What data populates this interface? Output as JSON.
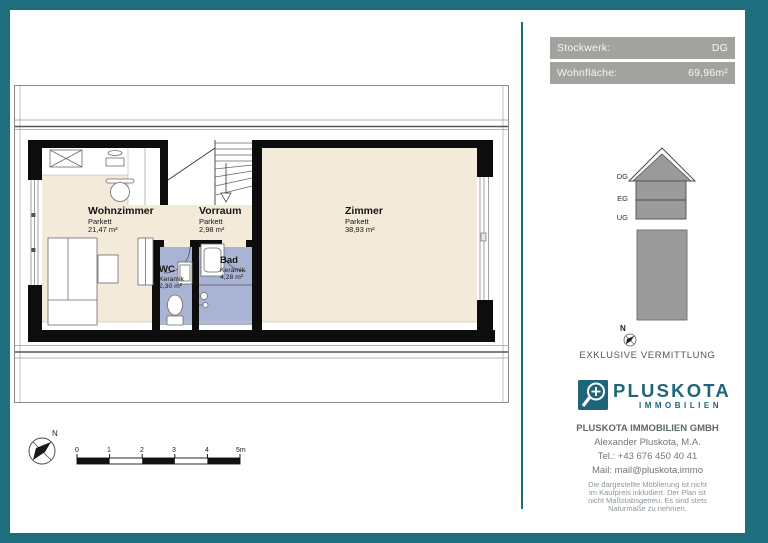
{
  "colors": {
    "frame_teal": "#1E6F7E",
    "logo_teal": "#1F6579",
    "header_gray": "#A2A29E",
    "floor_parquet": "#F3EAD9",
    "floor_ceramic": "#A9B3D4",
    "wall_black": "#0D0D0D",
    "diagram_gray": "#9B9B9B"
  },
  "header": {
    "rows": [
      {
        "label": "Stockwerk:",
        "value": "DG"
      },
      {
        "label": "Wohnfläche:",
        "value": "69,96m²"
      }
    ]
  },
  "plan": {
    "compass_label": "N",
    "rooms": [
      {
        "name": "Wohnzimmer",
        "floor": "Parkett",
        "area": "21,47 m²"
      },
      {
        "name": "Vorraum",
        "floor": "Parkett",
        "area": "2,98 m²"
      },
      {
        "name": "Zimmer",
        "floor": "Parkett",
        "area": "38,93 m²"
      },
      {
        "name": "WC",
        "floor": "Keramik",
        "area": "2,30 m²"
      },
      {
        "name": "Bad",
        "floor": "Keramik",
        "area": "4,28 m²"
      }
    ],
    "scale_ticks": [
      "0",
      "1",
      "2",
      "3",
      "4",
      "5m"
    ]
  },
  "sidebar": {
    "house_levels": [
      "DG",
      "EG",
      "UG"
    ],
    "compass_label": "N",
    "tagline": "EXKLUSIVE VERMITTLUNG",
    "logo": {
      "name": "PLUSKOTA",
      "subtitle": "IMMOBILIEN"
    },
    "contact": {
      "company": "PLUSKOTA IMMOBILIEN GMBH",
      "person": "Alexander Pluskota, M.A.",
      "phone": "Tel.: +43 676 450 40 41",
      "email": "Mail: mail@pluskota.immo"
    },
    "disclaimer_lines": [
      "Die dargestellte Möblierung ist nicht",
      "im Kaufpreis inkludiert. Der Plan ist",
      "nicht Maßstabsgetreu. Es sind stets",
      "Naturmaße zu nehmen."
    ]
  }
}
